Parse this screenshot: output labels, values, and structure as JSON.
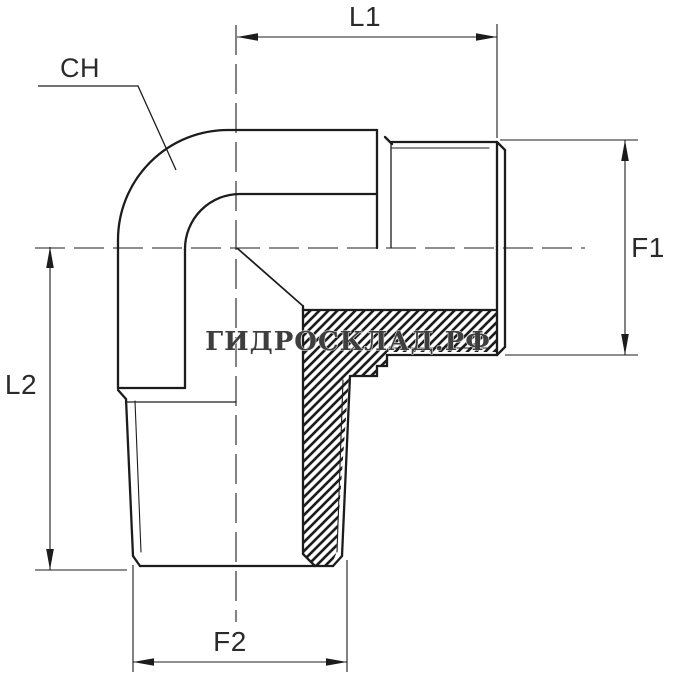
{
  "labels": {
    "l1": "L1",
    "l2": "L2",
    "f1": "F1",
    "f2": "F2",
    "ch": "CH"
  },
  "watermark": {
    "text": "ГИДРОСКЛАД.РФ"
  },
  "colors": {
    "background": "#ffffff",
    "line": "#1c1c1c",
    "label_text": "#2a2a2a",
    "watermark_fill": "#3e3e3e",
    "watermark_halo": "#f5f5f5"
  }
}
